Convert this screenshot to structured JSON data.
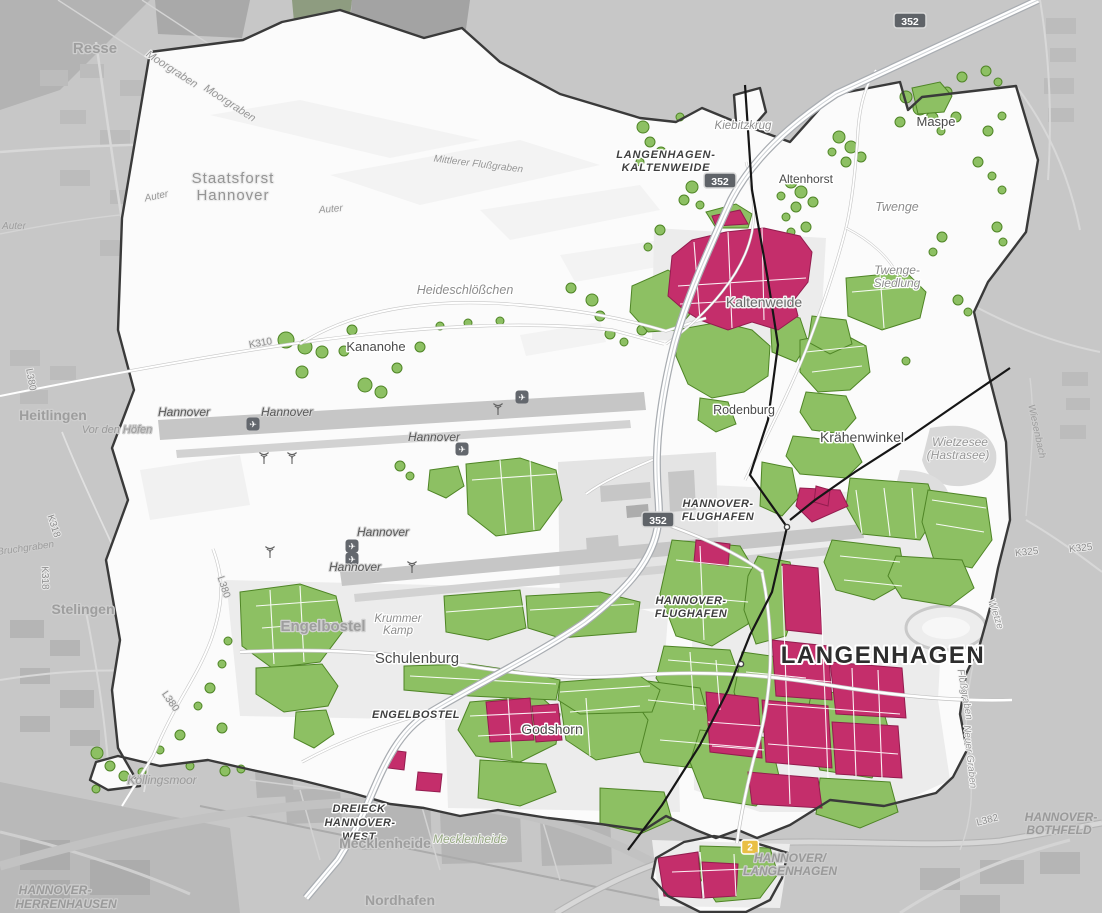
{
  "colors": {
    "outside": "#c7c7c7",
    "inside": "#fbfbfb",
    "boundary": "#3a3a3a",
    "green": "#8dc063",
    "green_border": "#4f8526",
    "pink": "#c42e6b",
    "pink_border": "#931d4f",
    "road_fill": "#ffffff",
    "road_casing": "#c2c2c2",
    "motorway_casing": "#a9adb2",
    "railway": "#161616",
    "runway": "#c6c6c6",
    "shield_bg": "#5f6368",
    "shield_border": "#d9d9d9",
    "shield_text": "#ffffff",
    "b_shield_bg": "#e9bf45"
  },
  "labels": [
    {
      "id": "resse",
      "text": "Resse",
      "x": 95,
      "y": 53,
      "cls": "city",
      "size": 15
    },
    {
      "id": "staatsforst-1",
      "text": "Staatsforst",
      "x": 233,
      "y": 183,
      "cls": "area",
      "size": 15
    },
    {
      "id": "staatsforst-2",
      "text": "Hannover",
      "x": 233,
      "y": 200,
      "cls": "area",
      "size": 15
    },
    {
      "id": "moorgraben-1",
      "text": "Moorgraben",
      "x": 170,
      "y": 72,
      "cls": "water",
      "size": 11,
      "rot": 33
    },
    {
      "id": "moorgraben-2",
      "text": "Moorgraben",
      "x": 228,
      "y": 106,
      "cls": "water",
      "size": 11,
      "rot": 33
    },
    {
      "id": "mittlerer-flussgraben",
      "text": "Mittlerer Flußgraben",
      "x": 478,
      "y": 167,
      "cls": "water",
      "size": 10,
      "rot": 7
    },
    {
      "id": "auter-1",
      "text": "Auter",
      "x": 157,
      "y": 199,
      "cls": "water",
      "size": 10,
      "rot": -12
    },
    {
      "id": "auter-2",
      "text": "Auter",
      "x": 331,
      "y": 212,
      "cls": "water",
      "size": 10,
      "rot": -5
    },
    {
      "id": "auter-3",
      "text": "Auter",
      "x": 14,
      "y": 229,
      "cls": "water-out",
      "size": 10
    },
    {
      "id": "langenhagen-kaltenweide-1",
      "text": "LANGENHAGEN-",
      "x": 666,
      "y": 158,
      "cls": "mwdark",
      "size": 11,
      "ls": 0.8
    },
    {
      "id": "langenhagen-kaltenweide-2",
      "text": "KALTENWEIDE",
      "x": 666,
      "y": 171,
      "cls": "mwdark",
      "size": 11,
      "ls": 0.8
    },
    {
      "id": "kiebitzkrug",
      "text": "Kiebitzkrug",
      "x": 743,
      "y": 129,
      "cls": "hamlet",
      "size": 11.5
    },
    {
      "id": "maspe",
      "text": "Maspe",
      "x": 936,
      "y": 126,
      "cls": "place",
      "size": 13
    },
    {
      "id": "altenhorst",
      "text": "Altenhorst",
      "x": 806,
      "y": 183,
      "cls": "place",
      "size": 12
    },
    {
      "id": "twenge",
      "text": "Twenge",
      "x": 897,
      "y": 211,
      "cls": "hamlet",
      "size": 12.5
    },
    {
      "id": "twenge-siedlung-1",
      "text": "Twenge-",
      "x": 897,
      "y": 274,
      "cls": "hamlet",
      "size": 12
    },
    {
      "id": "twenge-siedlung-2",
      "text": "Siedlung",
      "x": 897,
      "y": 287,
      "cls": "hamlet",
      "size": 12
    },
    {
      "id": "heideschloesschen",
      "text": "Heideschlößchen",
      "x": 465,
      "y": 294,
      "cls": "hamlet",
      "size": 12.5
    },
    {
      "id": "kananohe",
      "text": "Kananohe",
      "x": 376,
      "y": 351,
      "cls": "place",
      "size": 13
    },
    {
      "id": "k310",
      "text": "K310",
      "x": 261,
      "y": 346,
      "cls": "roadname",
      "size": 10,
      "rot": -10
    },
    {
      "id": "kaltenweide",
      "text": "Kaltenweide",
      "x": 764,
      "y": 307,
      "cls": "place-light",
      "size": 14
    },
    {
      "id": "heitlingen",
      "text": "Heitlingen",
      "x": 53,
      "y": 420,
      "cls": "city",
      "size": 14
    },
    {
      "id": "vor-den-hoefen",
      "text": "Vor den Höfen",
      "x": 117,
      "y": 433,
      "cls": "hamlet-out",
      "size": 11
    },
    {
      "id": "k318-a",
      "text": "K318",
      "x": 51,
      "y": 527,
      "cls": "roadname",
      "size": 10,
      "rot": 72
    },
    {
      "id": "k318-b",
      "text": "K318",
      "x": 42,
      "y": 578,
      "cls": "roadname",
      "size": 10,
      "rot": 88
    },
    {
      "id": "bruchgraben",
      "text": "Bruchgraben",
      "x": 26,
      "y": 551,
      "cls": "water-out",
      "size": 10,
      "rot": -8
    },
    {
      "id": "stelingen",
      "text": "Stelingen",
      "x": 83,
      "y": 614,
      "cls": "city",
      "size": 14
    },
    {
      "id": "hannover-rwy-1",
      "text": "Hannover",
      "x": 184,
      "y": 416,
      "cls": "rwy",
      "size": 12
    },
    {
      "id": "hannover-rwy-2",
      "text": "Hannover",
      "x": 287,
      "y": 416,
      "cls": "rwy",
      "size": 12
    },
    {
      "id": "hannover-rwy-3",
      "text": "Hannover",
      "x": 434,
      "y": 441,
      "cls": "rwy",
      "size": 12
    },
    {
      "id": "hannover-rwy-4",
      "text": "Hannover",
      "x": 383,
      "y": 536,
      "cls": "rwy",
      "size": 12
    },
    {
      "id": "hannover-rwy-5",
      "text": "Hannover",
      "x": 355,
      "y": 571,
      "cls": "rwy",
      "size": 12
    },
    {
      "id": "rodenburg",
      "text": "Rodenburg",
      "x": 744,
      "y": 414,
      "cls": "place",
      "size": 12.5
    },
    {
      "id": "kraehenwinkel",
      "text": "Krähenwinkel",
      "x": 862,
      "y": 442,
      "cls": "place",
      "size": 14
    },
    {
      "id": "wietzesee-1",
      "text": "Wietzesee",
      "x": 960,
      "y": 446,
      "cls": "water",
      "size": 12
    },
    {
      "id": "wietzesee-2",
      "text": "(Hastrasee)",
      "x": 958,
      "y": 459,
      "cls": "water",
      "size": 12
    },
    {
      "id": "wiesenbach",
      "text": "Wiesenbach",
      "x": 1034,
      "y": 432,
      "cls": "water-out",
      "size": 10,
      "rot": 78
    },
    {
      "id": "k325-a",
      "text": "K325",
      "x": 1027,
      "y": 555,
      "cls": "roadname",
      "size": 10,
      "rot": -6
    },
    {
      "id": "k325-b",
      "text": "K325",
      "x": 1081,
      "y": 551,
      "cls": "roadname",
      "size": 10,
      "rot": -6
    },
    {
      "id": "hannover-flughafen-1a",
      "text": "HANNOVER-",
      "x": 718,
      "y": 507,
      "cls": "mwdark",
      "size": 11,
      "ls": 0.5
    },
    {
      "id": "hannover-flughafen-1b",
      "text": "FLUGHAFEN",
      "x": 718,
      "y": 520,
      "cls": "mwdark",
      "size": 11,
      "ls": 0.5
    },
    {
      "id": "hannover-flughafen-2a",
      "text": "HANNOVER-",
      "x": 691,
      "y": 604,
      "cls": "mwdark",
      "size": 11,
      "ls": 0.5
    },
    {
      "id": "hannover-flughafen-2b",
      "text": "FLUGHAFEN",
      "x": 691,
      "y": 617,
      "cls": "mwdark",
      "size": 11,
      "ls": 0.5
    },
    {
      "id": "langenhagen-city",
      "text": "LANGENHAGEN",
      "x": 883,
      "y": 663,
      "cls": "big",
      "size": 24,
      "ls": 1.5
    },
    {
      "id": "wietze",
      "text": "Wietze",
      "x": 993,
      "y": 615,
      "cls": "water",
      "size": 10,
      "rot": 72
    },
    {
      "id": "flussgraben",
      "text": "Flußgraben",
      "x": 962,
      "y": 695,
      "cls": "water",
      "size": 10,
      "rot": 80
    },
    {
      "id": "neuer-graben",
      "text": "Neuer Graben",
      "x": 967,
      "y": 757,
      "cls": "water",
      "size": 10,
      "rot": 84
    },
    {
      "id": "engelbostel",
      "text": "Engelbostel",
      "x": 323,
      "y": 631,
      "cls": "city",
      "size": 15
    },
    {
      "id": "krummer-kamp-1",
      "text": "Krummer",
      "x": 398,
      "y": 622,
      "cls": "hamlet",
      "size": 11.5
    },
    {
      "id": "krummer-kamp-2",
      "text": "Kamp",
      "x": 398,
      "y": 634,
      "cls": "hamlet",
      "size": 11.5
    },
    {
      "id": "schulenburg",
      "text": "Schulenburg",
      "x": 417,
      "y": 663,
      "cls": "place",
      "size": 15
    },
    {
      "id": "engelbostel-junction",
      "text": "ENGELBOSTEL",
      "x": 416,
      "y": 718,
      "cls": "mwdark",
      "size": 11,
      "ls": 0.5
    },
    {
      "id": "godshorn",
      "text": "Godshorn",
      "x": 552,
      "y": 734,
      "cls": "place",
      "size": 14
    },
    {
      "id": "l380-a",
      "text": "L380",
      "x": 221,
      "y": 588,
      "cls": "roadname",
      "size": 10,
      "rot": 72
    },
    {
      "id": "l380-b",
      "text": "L380",
      "x": 168,
      "y": 703,
      "cls": "roadname",
      "size": 10,
      "rot": 55
    },
    {
      "id": "l380-c",
      "text": "L380",
      "x": 28,
      "y": 380,
      "cls": "roadname",
      "size": 10,
      "rot": 80
    },
    {
      "id": "koellingsmoor",
      "text": "Köllingsmoor",
      "x": 162,
      "y": 784,
      "cls": "hamlet-out",
      "size": 12
    },
    {
      "id": "dreieck-1",
      "text": "DREIECK",
      "x": 359,
      "y": 812,
      "cls": "mwdark",
      "size": 11,
      "ls": 0.5
    },
    {
      "id": "dreieck-2",
      "text": "HANNOVER-",
      "x": 360,
      "y": 826,
      "cls": "mwdark",
      "size": 11,
      "ls": 0.5
    },
    {
      "id": "dreieck-3",
      "text": "WEST",
      "x": 359,
      "y": 840,
      "cls": "mwdark",
      "size": 11,
      "ls": 0.5
    },
    {
      "id": "mecklenheide-1",
      "text": "Mecklenheide",
      "x": 385,
      "y": 848,
      "cls": "city",
      "size": 14
    },
    {
      "id": "mecklenheide-2",
      "text": "Mecklenheide",
      "x": 470,
      "y": 843,
      "cls": "forest",
      "size": 12
    },
    {
      "id": "nordhafen",
      "text": "Nordhafen",
      "x": 400,
      "y": 905,
      "cls": "city",
      "size": 14
    },
    {
      "id": "herrenhausen-1",
      "text": "HANNOVER-",
      "x": 55,
      "y": 894,
      "cls": "mwgray",
      "size": 12
    },
    {
      "id": "herrenhausen-2",
      "text": "HERRENHAUSEN",
      "x": 66,
      "y": 908,
      "cls": "mwgray",
      "size": 12
    },
    {
      "id": "hannover-langenhagen-1",
      "text": "HANNOVER/",
      "x": 790,
      "y": 862,
      "cls": "mwgray",
      "size": 12
    },
    {
      "id": "hannover-langenhagen-2",
      "text": "LANGENHAGEN",
      "x": 790,
      "y": 875,
      "cls": "mwgray",
      "size": 12
    },
    {
      "id": "bothfeld-1",
      "text": "HANNOVER-",
      "x": 1061,
      "y": 821,
      "cls": "mwgray",
      "size": 12
    },
    {
      "id": "bothfeld-2",
      "text": "BOTHFELD",
      "x": 1059,
      "y": 834,
      "cls": "mwgray",
      "size": 12
    },
    {
      "id": "l382",
      "text": "L382",
      "x": 988,
      "y": 823,
      "cls": "roadname",
      "size": 10,
      "rot": -14
    }
  ],
  "shields": [
    {
      "id": "shield-352-kaltenweide",
      "text": "352",
      "x": 720,
      "y": 181,
      "type": "motorway"
    },
    {
      "id": "shield-352-north",
      "text": "352",
      "x": 910,
      "y": 21,
      "type": "motorway"
    },
    {
      "id": "shield-352-airport",
      "text": "352",
      "x": 658,
      "y": 520,
      "type": "motorway"
    },
    {
      "id": "shield-2-b2",
      "text": "2",
      "x": 750,
      "y": 847,
      "type": "b-road"
    }
  ],
  "icons": [
    {
      "type": "airplane-icon",
      "x": 253,
      "y": 424
    },
    {
      "type": "airplane-icon",
      "x": 462,
      "y": 449
    },
    {
      "type": "airplane-icon",
      "x": 522,
      "y": 397
    },
    {
      "type": "airplane-icon",
      "x": 352,
      "y": 546
    },
    {
      "type": "airplane-icon",
      "x": 352,
      "y": 559
    },
    {
      "type": "antenna-icon",
      "x": 264,
      "y": 459
    },
    {
      "type": "antenna-icon",
      "x": 292,
      "y": 459
    },
    {
      "type": "antenna-icon",
      "x": 498,
      "y": 410
    },
    {
      "type": "antenna-icon",
      "x": 270,
      "y": 553
    },
    {
      "type": "antenna-icon",
      "x": 412,
      "y": 568
    },
    {
      "type": "station-icon",
      "x": 787,
      "y": 527
    },
    {
      "type": "station-icon",
      "x": 741,
      "y": 664
    }
  ]
}
